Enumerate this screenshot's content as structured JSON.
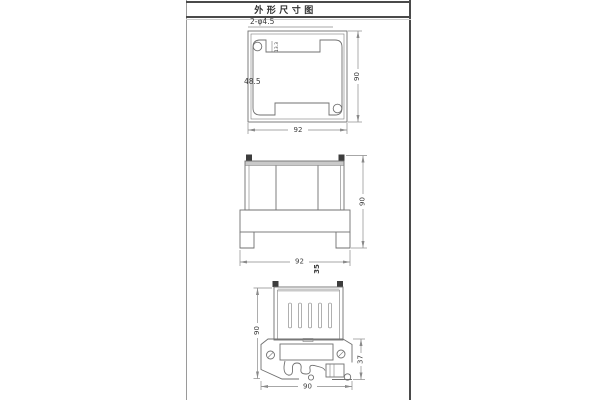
{
  "title": "外形尺寸图",
  "views": {
    "top": {
      "hole_callout": "2-φ4.5",
      "notch_depth": "13.3",
      "slot_width": "48.5",
      "height": "90",
      "width": "92"
    },
    "front": {
      "height": "90",
      "width": "92",
      "depth": "35"
    },
    "side": {
      "height": "90",
      "rail_section_height": "37",
      "width": "90"
    }
  },
  "colors": {
    "object_line": "#707070",
    "dimension_line": "#8a8a8a",
    "text": "#3c3c3c",
    "dark_fill": "#3d3d3d",
    "shade_band": "#c9c9c9",
    "frame_border": "#4a4a4a",
    "background": "#ffffff"
  }
}
